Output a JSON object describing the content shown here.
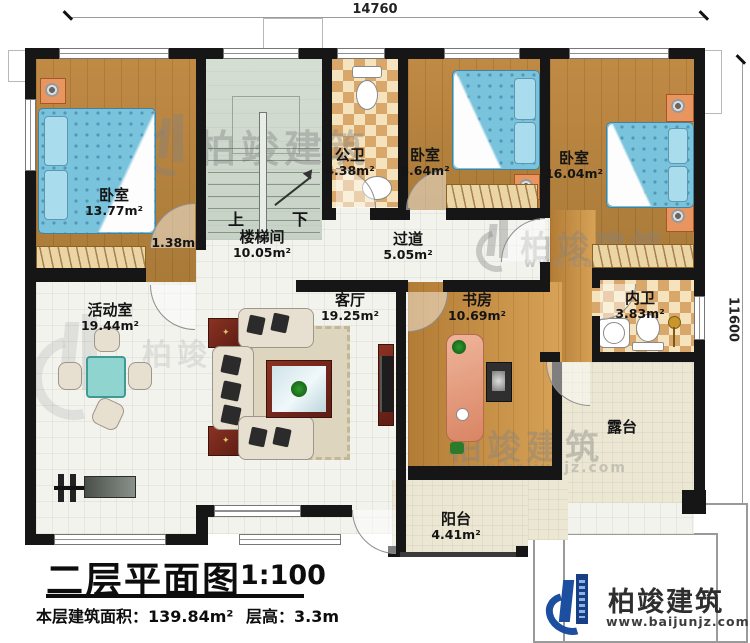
{
  "dimensions": {
    "top": "14760",
    "right": "11600"
  },
  "rooms": {
    "bedroom1": {
      "name": "卧室",
      "area": "13.77m²"
    },
    "stairwell": {
      "name": "楼梯间",
      "area": "10.05m²"
    },
    "corridor": {
      "area": "1.38m²"
    },
    "public_bath": {
      "name": "公卫",
      "area": "4.38m²"
    },
    "bedroom2": {
      "name": "卧室",
      "area": "8.64m²"
    },
    "bedroom3": {
      "name": "卧室",
      "area": "16.04m²"
    },
    "hallway": {
      "name": "过道",
      "area": "5.05m²"
    },
    "activity": {
      "name": "活动室",
      "area": "19.44m²"
    },
    "living": {
      "name": "客厅",
      "area": "19.25m²"
    },
    "study": {
      "name": "书房",
      "area": "10.69m²"
    },
    "inner_bath": {
      "name": "内卫",
      "area": "3.83m²"
    },
    "terrace": {
      "name": "露台"
    },
    "balcony": {
      "name": "阳台",
      "area": "4.41m²"
    }
  },
  "stairs": {
    "up": "上",
    "down": "下"
  },
  "title_block": {
    "title": "二层平面图",
    "scale": "1:100",
    "area_label": "本层建筑面积：",
    "area_value": "139.84m²",
    "floor_height_label": "层高：",
    "floor_height_value": "3.3m"
  },
  "branding": {
    "name": "柏竣建筑",
    "website": "www.baijunjz.com",
    "logo_color": "#1d4fa0"
  },
  "watermark": {
    "name": "柏竣建筑",
    "website": "www.baijunjz.com"
  },
  "colors": {
    "wall": "#161616",
    "wood": "#b5813f",
    "bed_blue": "#79c3dc",
    "checker_tan": "#d9a76a",
    "logo_blue": "#1d4fa0"
  }
}
